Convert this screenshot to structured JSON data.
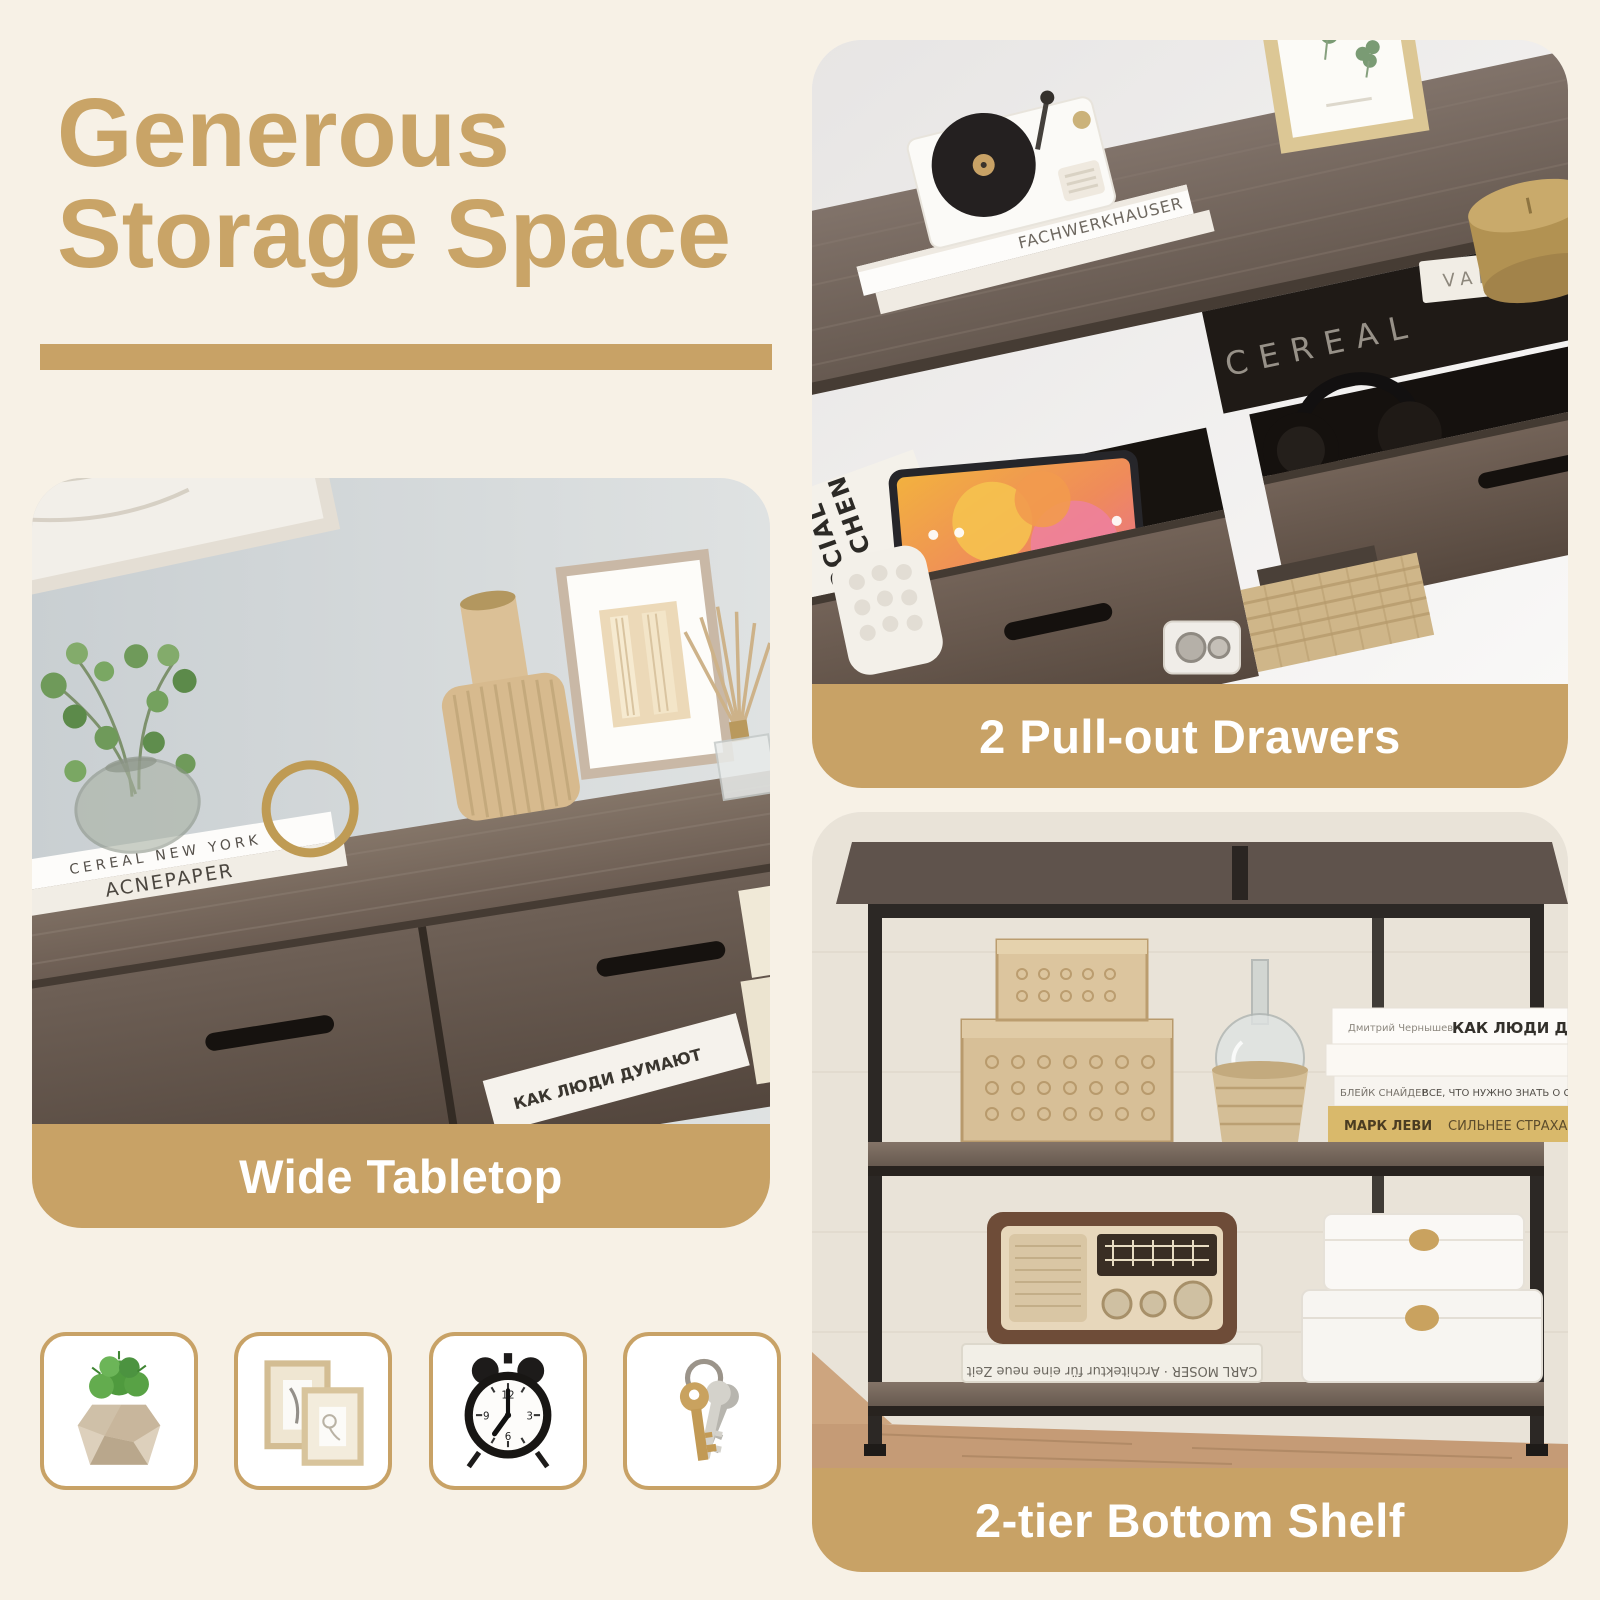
{
  "page": {
    "colors": {
      "background": "#f7f1e6",
      "accent": "#c8a266",
      "accent_heading": "#c9a467",
      "caption_text": "#ffffff"
    },
    "heading": {
      "line1": "Generous",
      "line2": "Storage Space"
    }
  },
  "features": {
    "drawers": {
      "caption": "2 Pull-out Drawers",
      "photo_text": {
        "book_title": "FACHWERKHAUSER",
        "magazine_word1": "SOCIAL",
        "magazine_word2": "KITCHEN",
        "cavity_magazine": "CEREAL",
        "cavity_book": "VAN"
      }
    },
    "tabletop": {
      "caption": "Wide Tabletop",
      "photo_text": {
        "spine": "CEREAL",
        "cover_top": "CEREAL NEW YORK",
        "cover_bottom": "ACNEPAPER",
        "shelf_book": "КАК ЛЮДИ ДУМАЮТ"
      }
    },
    "shelf": {
      "caption": "2-tier Bottom Shelf",
      "photo_text": {
        "book1_author": "Дмитрий Чернышев",
        "book1_title": "КАК ЛЮДИ ДУМАЮТ",
        "book2_author": "БЛЕЙК СНАЙДЕР",
        "book2_title": "ВСЕ, ЧТО НУЖНО ЗНАТЬ О СЦЕНАРИИ",
        "book3_author": "МАРК ЛЕВИ",
        "book3_title": "СИЛЬНЕЕ СТРАХА",
        "floor_book": "CARL MOSER · Architektur für eine neue Zeit"
      }
    }
  },
  "accessories": {
    "items": [
      {
        "name": "potted-plant-icon"
      },
      {
        "name": "picture-frames-icon"
      },
      {
        "name": "alarm-clock-icon"
      },
      {
        "name": "keys-icon"
      }
    ]
  }
}
